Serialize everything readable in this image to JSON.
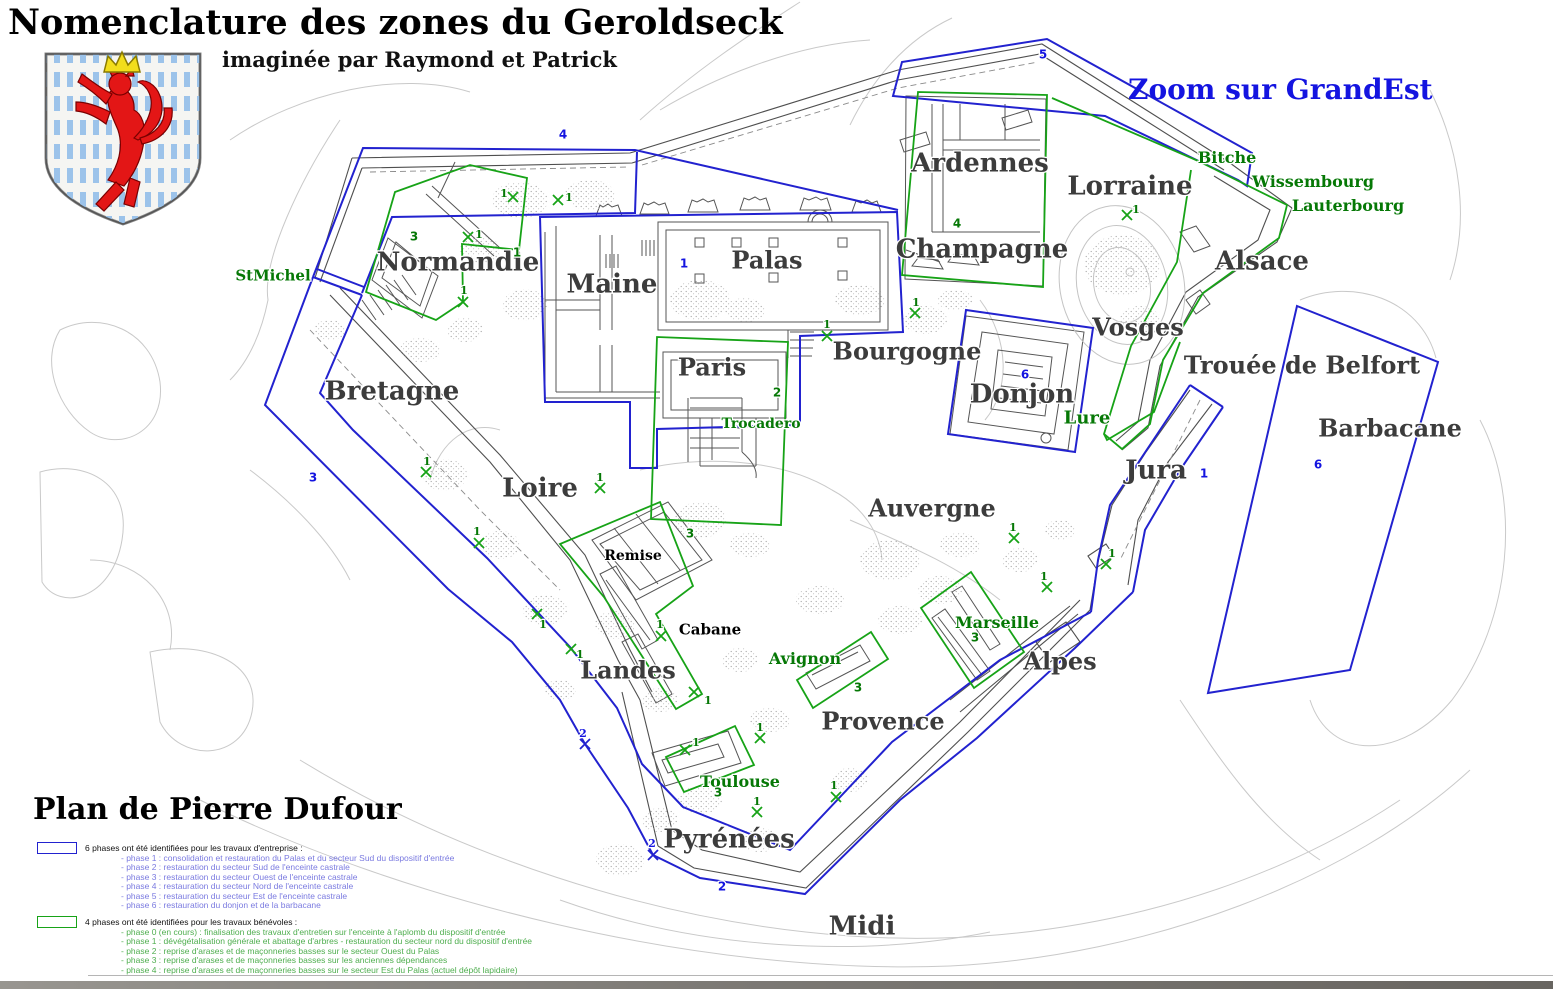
{
  "header": {
    "title": "Nomenclature des zones du Geroldseck",
    "subtitle": "imaginée par Raymond et Patrick",
    "zoom_note": "Zoom sur GrandEst",
    "plan_credit": "Plan de Pierre Dufour",
    "coat_of_arms": "luxembourg-lion-shield"
  },
  "colors": {
    "zone_blue": "#2222cf",
    "zone_green": "#17a317",
    "region_text": "#3c3c3c",
    "green_text": "#067806",
    "blue_text": "#1414e0",
    "legend_blue_text": "#7a7ae0",
    "legend_green_text": "#4fae4f"
  },
  "legend_blue": {
    "heading": "6 phases ont été identifiées pour les travaux d'entreprise :",
    "items": [
      "- phase 1 : consolidation et restauration du Palas et du secteur Sud du dispositif d'entrée",
      "- phase 2 : restauration du secteur Sud de l'enceinte castrale",
      "- phase 3 : restauration du secteur Ouest de l'enceinte castrale",
      "- phase 4 : restauration du secteur Nord de l'enceinte castrale",
      "- phase 5 : restauration du secteur Est de l'enceinte castrale",
      "- phase 6 : restauration du donjon et de la barbacane"
    ]
  },
  "legend_green": {
    "heading": "4 phases ont été identifiées pour les travaux bénévoles :",
    "items": [
      "- phase 0 (en cours) : finalisation des travaux d'entretien sur l'enceinte à l'aplomb du dispositif d'entrée",
      "- phase 1 : dévégétalisation générale et abattage d'arbres - restauration du secteur nord du dispositif d'entrée",
      "- phase 2 : reprise d'arases et de maçonneries basses sur le secteur Ouest du Palas",
      "- phase 3 : reprise d'arases et de maçonneries basses sur les anciennes dépendances",
      "- phase 4 : reprise d'arases et de maçonneries basses sur le secteur Est du Palas (actuel dépôt lapidaire)"
    ]
  },
  "map": {
    "region_labels": [
      {
        "t": "Ardennes",
        "x": 980,
        "y": 162,
        "fs": 26
      },
      {
        "t": "Lorraine",
        "x": 1130,
        "y": 185,
        "fs": 26
      },
      {
        "t": "Champagne",
        "x": 982,
        "y": 248,
        "fs": 26
      },
      {
        "t": "Alsace",
        "x": 1262,
        "y": 260,
        "fs": 26
      },
      {
        "t": "Palas",
        "x": 767,
        "y": 260,
        "fs": 24
      },
      {
        "t": "Maine",
        "x": 612,
        "y": 283,
        "fs": 26
      },
      {
        "t": "Normandie",
        "x": 458,
        "y": 261,
        "fs": 26
      },
      {
        "t": "Bourgogne",
        "x": 907,
        "y": 351,
        "fs": 24
      },
      {
        "t": "Vosges",
        "x": 1138,
        "y": 327,
        "fs": 24
      },
      {
        "t": "Paris",
        "x": 712,
        "y": 367,
        "fs": 24
      },
      {
        "t": "Donjon",
        "x": 1022,
        "y": 393,
        "fs": 26
      },
      {
        "t": "Trouée de Belfort",
        "x": 1302,
        "y": 365,
        "fs": 24
      },
      {
        "t": "Bretagne",
        "x": 392,
        "y": 390,
        "fs": 26
      },
      {
        "t": "Barbacane",
        "x": 1390,
        "y": 428,
        "fs": 24
      },
      {
        "t": "Jura",
        "x": 1156,
        "y": 469,
        "fs": 26
      },
      {
        "t": "Loire",
        "x": 540,
        "y": 487,
        "fs": 26
      },
      {
        "t": "Auvergne",
        "x": 932,
        "y": 508,
        "fs": 24
      },
      {
        "t": "Landes",
        "x": 628,
        "y": 670,
        "fs": 24
      },
      {
        "t": "Alpes",
        "x": 1060,
        "y": 661,
        "fs": 24
      },
      {
        "t": "Provence",
        "x": 883,
        "y": 721,
        "fs": 24
      },
      {
        "t": "Pyrénées",
        "x": 729,
        "y": 838,
        "fs": 26
      },
      {
        "t": "Midi",
        "x": 862,
        "y": 925,
        "fs": 26
      }
    ],
    "building_labels": [
      {
        "t": "Remise",
        "x": 633,
        "y": 555,
        "fs": 14
      },
      {
        "t": "Cabane",
        "x": 710,
        "y": 629,
        "fs": 15
      }
    ],
    "green_labels": [
      {
        "t": "StMichel",
        "x": 273,
        "y": 275,
        "fs": 15
      },
      {
        "t": "Bitche",
        "x": 1227,
        "y": 157,
        "fs": 16
      },
      {
        "t": "Wissembourg",
        "x": 1313,
        "y": 181,
        "fs": 16
      },
      {
        "t": "Lauterbourg",
        "x": 1348,
        "y": 205,
        "fs": 16
      },
      {
        "t": "Trocadero",
        "x": 761,
        "y": 423,
        "fs": 14
      },
      {
        "t": "Lure",
        "x": 1087,
        "y": 417,
        "fs": 18
      },
      {
        "t": "Avignon",
        "x": 805,
        "y": 658,
        "fs": 16
      },
      {
        "t": "Marseille",
        "x": 997,
        "y": 622,
        "fs": 16
      },
      {
        "t": "Toulouse",
        "x": 740,
        "y": 781,
        "fs": 16
      }
    ],
    "blue_numbers": [
      {
        "t": "4",
        "x": 563,
        "y": 134
      },
      {
        "t": "5",
        "x": 1043,
        "y": 54
      },
      {
        "t": "3",
        "x": 313,
        "y": 477
      },
      {
        "t": "1",
        "x": 684,
        "y": 263
      },
      {
        "t": "6",
        "x": 1025,
        "y": 374
      },
      {
        "t": "1",
        "x": 1204,
        "y": 473
      },
      {
        "t": "6",
        "x": 1318,
        "y": 464
      },
      {
        "t": "2",
        "x": 722,
        "y": 886
      }
    ],
    "green_numbers": [
      {
        "t": "3",
        "x": 414,
        "y": 236
      },
      {
        "t": "4",
        "x": 957,
        "y": 223
      },
      {
        "t": "2",
        "x": 777,
        "y": 392
      },
      {
        "t": "3",
        "x": 690,
        "y": 533
      },
      {
        "t": "3",
        "x": 858,
        "y": 687
      },
      {
        "t": "3",
        "x": 975,
        "y": 637
      },
      {
        "t": "3",
        "x": 718,
        "y": 792
      },
      {
        "t": "1",
        "x": 517,
        "y": 252
      }
    ],
    "x_marks_green": [
      {
        "x": 513,
        "y": 197,
        "label": "1",
        "lx": 504,
        "ly": 193
      },
      {
        "x": 558,
        "y": 200,
        "label": "1",
        "lx": 569,
        "ly": 197
      },
      {
        "x": 468,
        "y": 237,
        "label": "1",
        "lx": 479,
        "ly": 234
      },
      {
        "x": 463,
        "y": 302,
        "label": "1",
        "lx": 464,
        "ly": 290
      },
      {
        "x": 426,
        "y": 472,
        "label": "1",
        "lx": 427,
        "ly": 461
      },
      {
        "x": 479,
        "y": 543,
        "label": "1",
        "lx": 477,
        "ly": 531
      },
      {
        "x": 537,
        "y": 614,
        "label": "1",
        "lx": 543,
        "ly": 624
      },
      {
        "x": 571,
        "y": 649,
        "label": "1",
        "lx": 580,
        "ly": 654
      },
      {
        "x": 600,
        "y": 488,
        "label": "1",
        "lx": 600,
        "ly": 477
      },
      {
        "x": 661,
        "y": 636,
        "label": "1",
        "lx": 660,
        "ly": 624
      },
      {
        "x": 694,
        "y": 692,
        "label": "1",
        "lx": 708,
        "ly": 700
      },
      {
        "x": 827,
        "y": 336,
        "label": "1",
        "lx": 827,
        "ly": 324
      },
      {
        "x": 915,
        "y": 313,
        "label": "1",
        "lx": 916,
        "ly": 302
      },
      {
        "x": 1127,
        "y": 215,
        "label": "1",
        "lx": 1136,
        "ly": 209
      },
      {
        "x": 1014,
        "y": 538,
        "label": "1",
        "lx": 1013,
        "ly": 527
      },
      {
        "x": 1047,
        "y": 587,
        "label": "1",
        "lx": 1044,
        "ly": 576
      },
      {
        "x": 1106,
        "y": 564,
        "label": "1",
        "lx": 1112,
        "ly": 553
      },
      {
        "x": 757,
        "y": 812,
        "label": "1",
        "lx": 757,
        "ly": 801
      },
      {
        "x": 836,
        "y": 797,
        "label": "1",
        "lx": 834,
        "ly": 785
      },
      {
        "x": 685,
        "y": 750,
        "label": "1",
        "lx": 696,
        "ly": 742
      },
      {
        "x": 760,
        "y": 738,
        "label": "1",
        "lx": 760,
        "ly": 727
      }
    ],
    "x_marks_blue": [
      {
        "x": 585,
        "y": 744,
        "label": "2",
        "lx": 583,
        "ly": 733
      },
      {
        "x": 653,
        "y": 855,
        "label": "2",
        "lx": 652,
        "ly": 843
      }
    ]
  }
}
